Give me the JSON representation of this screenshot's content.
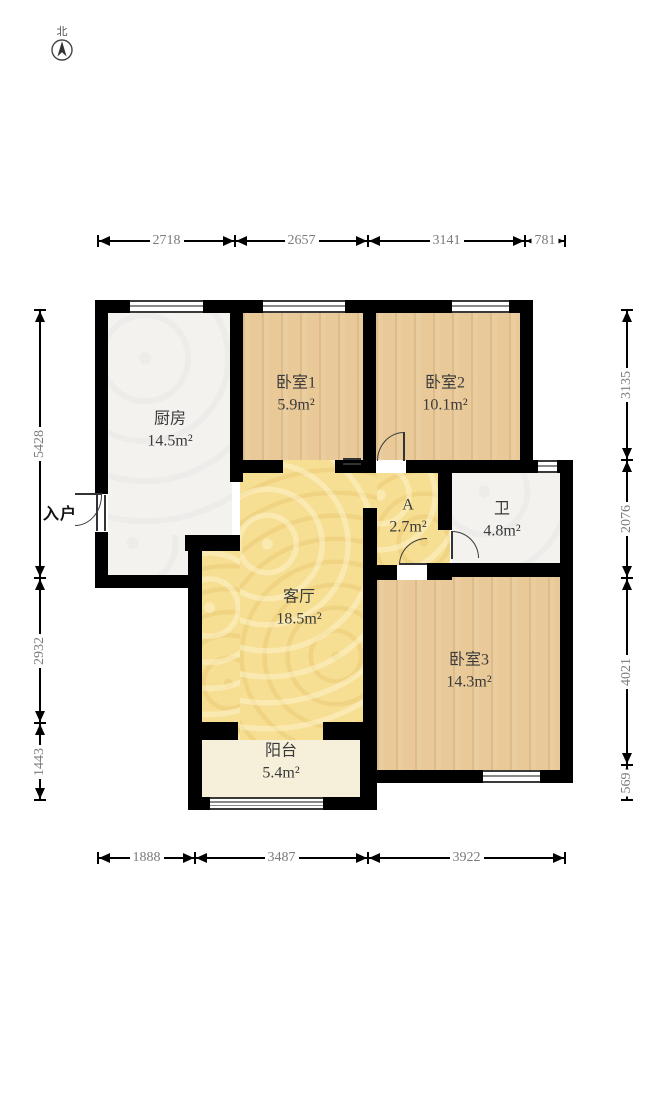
{
  "compass": {
    "label": "北"
  },
  "entrance": {
    "label": "入户"
  },
  "plan": {
    "colors": {
      "wall": "#000000",
      "wood_floor": "#e9c998",
      "tile_floor": "#f3f2ef",
      "hall_floor": "#f6de92",
      "balcony_floor": "#f6efda",
      "dim_text": "#7b7b7b"
    },
    "rooms": [
      {
        "id": "kitchen",
        "name": "厨房",
        "area": "14.5m²",
        "type": "tile",
        "x": 108,
        "y": 313,
        "w": 124,
        "h": 226,
        "lx": 170,
        "ly": 430
      },
      {
        "id": "kitchen-lower",
        "name": "",
        "area": "",
        "type": "tile",
        "x": 108,
        "y": 535,
        "w": 82,
        "h": 40
      },
      {
        "id": "bedroom1",
        "name": "卧室1",
        "area": "5.9m²",
        "type": "wood",
        "x": 243,
        "y": 313,
        "w": 120,
        "h": 150,
        "lx": 296,
        "ly": 394
      },
      {
        "id": "bedroom2",
        "name": "卧室2",
        "area": "10.1m²",
        "type": "wood",
        "x": 376,
        "y": 313,
        "w": 144,
        "h": 147,
        "lx": 445,
        "ly": 394
      },
      {
        "id": "hall",
        "name": "A",
        "area": "2.7m²",
        "type": "yellow",
        "x": 363,
        "y": 460,
        "w": 87,
        "h": 117,
        "lx": 408,
        "ly": 516
      },
      {
        "id": "bathroom",
        "name": "卫",
        "area": "4.8m²",
        "type": "tile",
        "x": 452,
        "y": 473,
        "w": 108,
        "h": 92,
        "lx": 502,
        "ly": 520
      },
      {
        "id": "living",
        "name": "客厅",
        "area": "18.5m²",
        "type": "yellow",
        "x": 240,
        "y": 460,
        "w": 137,
        "h": 280,
        "lx": 299,
        "ly": 608
      },
      {
        "id": "living-west",
        "name": "",
        "area": "",
        "type": "yellow",
        "x": 202,
        "y": 551,
        "w": 38,
        "h": 189
      },
      {
        "id": "bedroom3",
        "name": "卧室3",
        "area": "14.3m²",
        "type": "wood",
        "x": 377,
        "y": 577,
        "w": 183,
        "h": 193,
        "lx": 469,
        "ly": 671
      },
      {
        "id": "balcony",
        "name": "阳台",
        "area": "5.4m²",
        "type": "balcony-floor",
        "x": 202,
        "y": 740,
        "w": 158,
        "h": 57,
        "lx": 281,
        "ly": 762
      }
    ],
    "walls": [
      [
        95,
        300,
        438,
        13
      ],
      [
        95,
        300,
        13,
        196
      ],
      [
        95,
        531,
        13,
        57
      ],
      [
        95,
        575,
        95,
        13
      ],
      [
        185,
        535,
        55,
        16
      ],
      [
        188,
        551,
        14,
        259
      ],
      [
        230,
        300,
        13,
        182
      ],
      [
        363,
        300,
        13,
        173
      ],
      [
        232,
        460,
        51,
        13
      ],
      [
        335,
        460,
        41,
        13
      ],
      [
        406,
        460,
        34,
        13
      ],
      [
        438,
        460,
        135,
        13
      ],
      [
        520,
        300,
        13,
        160
      ],
      [
        560,
        460,
        13,
        323
      ],
      [
        438,
        473,
        14,
        57
      ],
      [
        438,
        563,
        122,
        14
      ],
      [
        363,
        508,
        14,
        60
      ],
      [
        363,
        565,
        34,
        15
      ],
      [
        427,
        563,
        25,
        17
      ],
      [
        363,
        568,
        14,
        154
      ],
      [
        188,
        722,
        50,
        18
      ],
      [
        323,
        722,
        54,
        18
      ],
      [
        360,
        722,
        17,
        75
      ],
      [
        188,
        797,
        189,
        13
      ],
      [
        377,
        770,
        196,
        13
      ]
    ],
    "windows": [
      {
        "rect": [
          130,
          300,
          73,
          13
        ],
        "style": "3"
      },
      {
        "rect": [
          263,
          300,
          82,
          13
        ],
        "style": "3"
      },
      {
        "rect": [
          452,
          300,
          57,
          13
        ],
        "style": "3"
      },
      {
        "rect": [
          538,
          460,
          19,
          13
        ],
        "style": "3"
      },
      {
        "rect": [
          483,
          770,
          57,
          13
        ],
        "style": "3"
      },
      {
        "rect": [
          210,
          797,
          113,
          13
        ],
        "style": "4"
      }
    ],
    "doors": [
      {
        "id": "entrance-door",
        "gap": [
          95,
          494,
          13,
          38
        ],
        "frame": [
          96,
          495,
          10,
          36
        ],
        "leaf": [
          75,
          493,
          27,
          2
        ],
        "arc": [
          75,
          495,
          27,
          31
        ],
        "corner": "se"
      },
      {
        "id": "bedroom1-door",
        "gap": null,
        "frame": null,
        "leaf": null,
        "lines": [
          343,
          458,
          18,
          7
        ],
        "arc": null,
        "corner": ""
      },
      {
        "id": "bedroom2-door",
        "gap": [
          376,
          460,
          30,
          13
        ],
        "frame": null,
        "leaf": [
          403,
          432,
          2,
          29
        ],
        "arc": [
          377,
          432,
          27,
          29
        ],
        "corner": "nw"
      },
      {
        "id": "bathroom-door",
        "gap": null,
        "frame": null,
        "leaf": [
          451,
          531,
          2,
          28
        ],
        "arc": [
          452,
          531,
          27,
          27
        ],
        "corner": "ne"
      },
      {
        "id": "bedroom3-door",
        "gap": [
          397,
          565,
          30,
          15
        ],
        "frame": null,
        "leaf": [
          399,
          563,
          28,
          2
        ],
        "arc": [
          399,
          538,
          28,
          27
        ],
        "corner": "nw"
      }
    ],
    "dims": {
      "top": {
        "y": 241,
        "segments": [
          {
            "label": "2718",
            "a": 98,
            "b": 235
          },
          {
            "label": "2657",
            "a": 235,
            "b": 368
          },
          {
            "label": "3141",
            "a": 368,
            "b": 525
          },
          {
            "label": "781",
            "a": 525,
            "b": 565
          }
        ]
      },
      "bottom": {
        "y": 858,
        "segments": [
          {
            "label": "1888",
            "a": 98,
            "b": 195
          },
          {
            "label": "3487",
            "a": 195,
            "b": 368
          },
          {
            "label": "3922",
            "a": 368,
            "b": 565
          }
        ]
      },
      "left": {
        "x": 40,
        "segments": [
          {
            "label": "5428",
            "a": 310,
            "b": 578
          },
          {
            "label": "2932",
            "a": 578,
            "b": 723
          },
          {
            "label": "1443",
            "a": 723,
            "b": 800
          }
        ]
      },
      "right": {
        "x": 627,
        "segments": [
          {
            "label": "3135",
            "a": 310,
            "b": 460
          },
          {
            "label": "2076",
            "a": 460,
            "b": 578
          },
          {
            "label": "4021",
            "a": 578,
            "b": 765
          },
          {
            "label": "569",
            "a": 765,
            "b": 800
          }
        ]
      }
    }
  }
}
